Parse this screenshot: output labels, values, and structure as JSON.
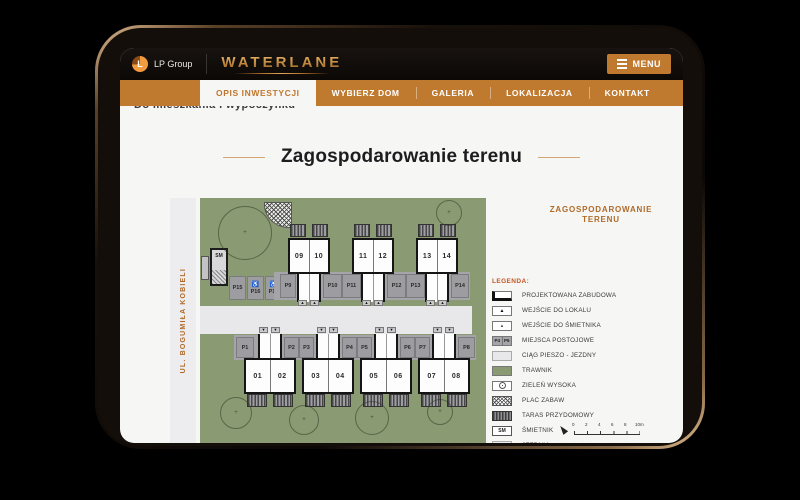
{
  "header": {
    "logo_letter": "L",
    "logo_text": "LP Group",
    "brand": "WATERLANE",
    "menu_label": "MENU"
  },
  "nav": {
    "tabs": [
      {
        "label": "OPIS INWESTYCJI",
        "active": true
      },
      {
        "label": "WYBIERZ DOM",
        "active": false
      },
      {
        "label": "GALERIA",
        "active": false
      },
      {
        "label": "LOKALIZACJA",
        "active": false
      },
      {
        "label": "KONTAKT",
        "active": false
      }
    ]
  },
  "page": {
    "clipped_heading": "Do mieszkania i wypoczynku",
    "title": "Zagospodarowanie terenu"
  },
  "plan": {
    "street_label": "UL. BOGUMIŁA KOBIELI",
    "top_units": [
      "09",
      "10",
      "11",
      "12",
      "13",
      "14"
    ],
    "bottom_units": [
      "01",
      "02",
      "03",
      "04",
      "05",
      "06",
      "07",
      "08"
    ],
    "top_parking": [
      "P9",
      "P10",
      "P11",
      "P12",
      "P13",
      "P14"
    ],
    "bottom_parking": [
      "P1",
      "P2",
      "P3",
      "P4",
      "P5",
      "P6",
      "P7",
      "P8"
    ],
    "side_parking": [
      "P15",
      "P16",
      "P17"
    ],
    "trash_shed_label": "SM",
    "accessible_icon": "♿",
    "arrow_up": "▲",
    "arrow_down": "▼",
    "tree_mark": "+"
  },
  "legend": {
    "panel_title_line1": "ZAGOSPODAROWANIE",
    "panel_title_line2": "TERENU",
    "heading": "LEGENDA:",
    "items": [
      {
        "label": "PROJEKTOWANA ZABUDOWA"
      },
      {
        "label": "WEJŚCIE DO LOKALU",
        "glyph": "▲"
      },
      {
        "label": "WEJŚCIE DO ŚMIETNIKA",
        "glyph": "▲"
      },
      {
        "label": "MIEJSCA POSTOJOWE",
        "cells": [
          "P4",
          "P5"
        ]
      },
      {
        "label": "CIĄG PIESZO - JEZDNY"
      },
      {
        "label": "TRAWNIK"
      },
      {
        "label": "ZIELEŃ WYSOKA"
      },
      {
        "label": "PLAC ZABAW"
      },
      {
        "label": "TARAS PRZYDOMOWY"
      },
      {
        "label": "ŚMIETNIK",
        "swatch_text": "SM"
      },
      {
        "label": "JEZDNIA"
      }
    ],
    "scale_ticks": [
      "0",
      "2",
      "4",
      "6",
      "8",
      "10m"
    ]
  },
  "colors": {
    "accent_orange": "#c07a30",
    "brand_gold": "#d29a4a",
    "plan_green": "#8a9a72",
    "road_gray": "#e8e8ea",
    "parking_gray": "#a5a5a9",
    "legend_heading_red": "#c2561f",
    "street_label_orange": "#b06a28"
  }
}
